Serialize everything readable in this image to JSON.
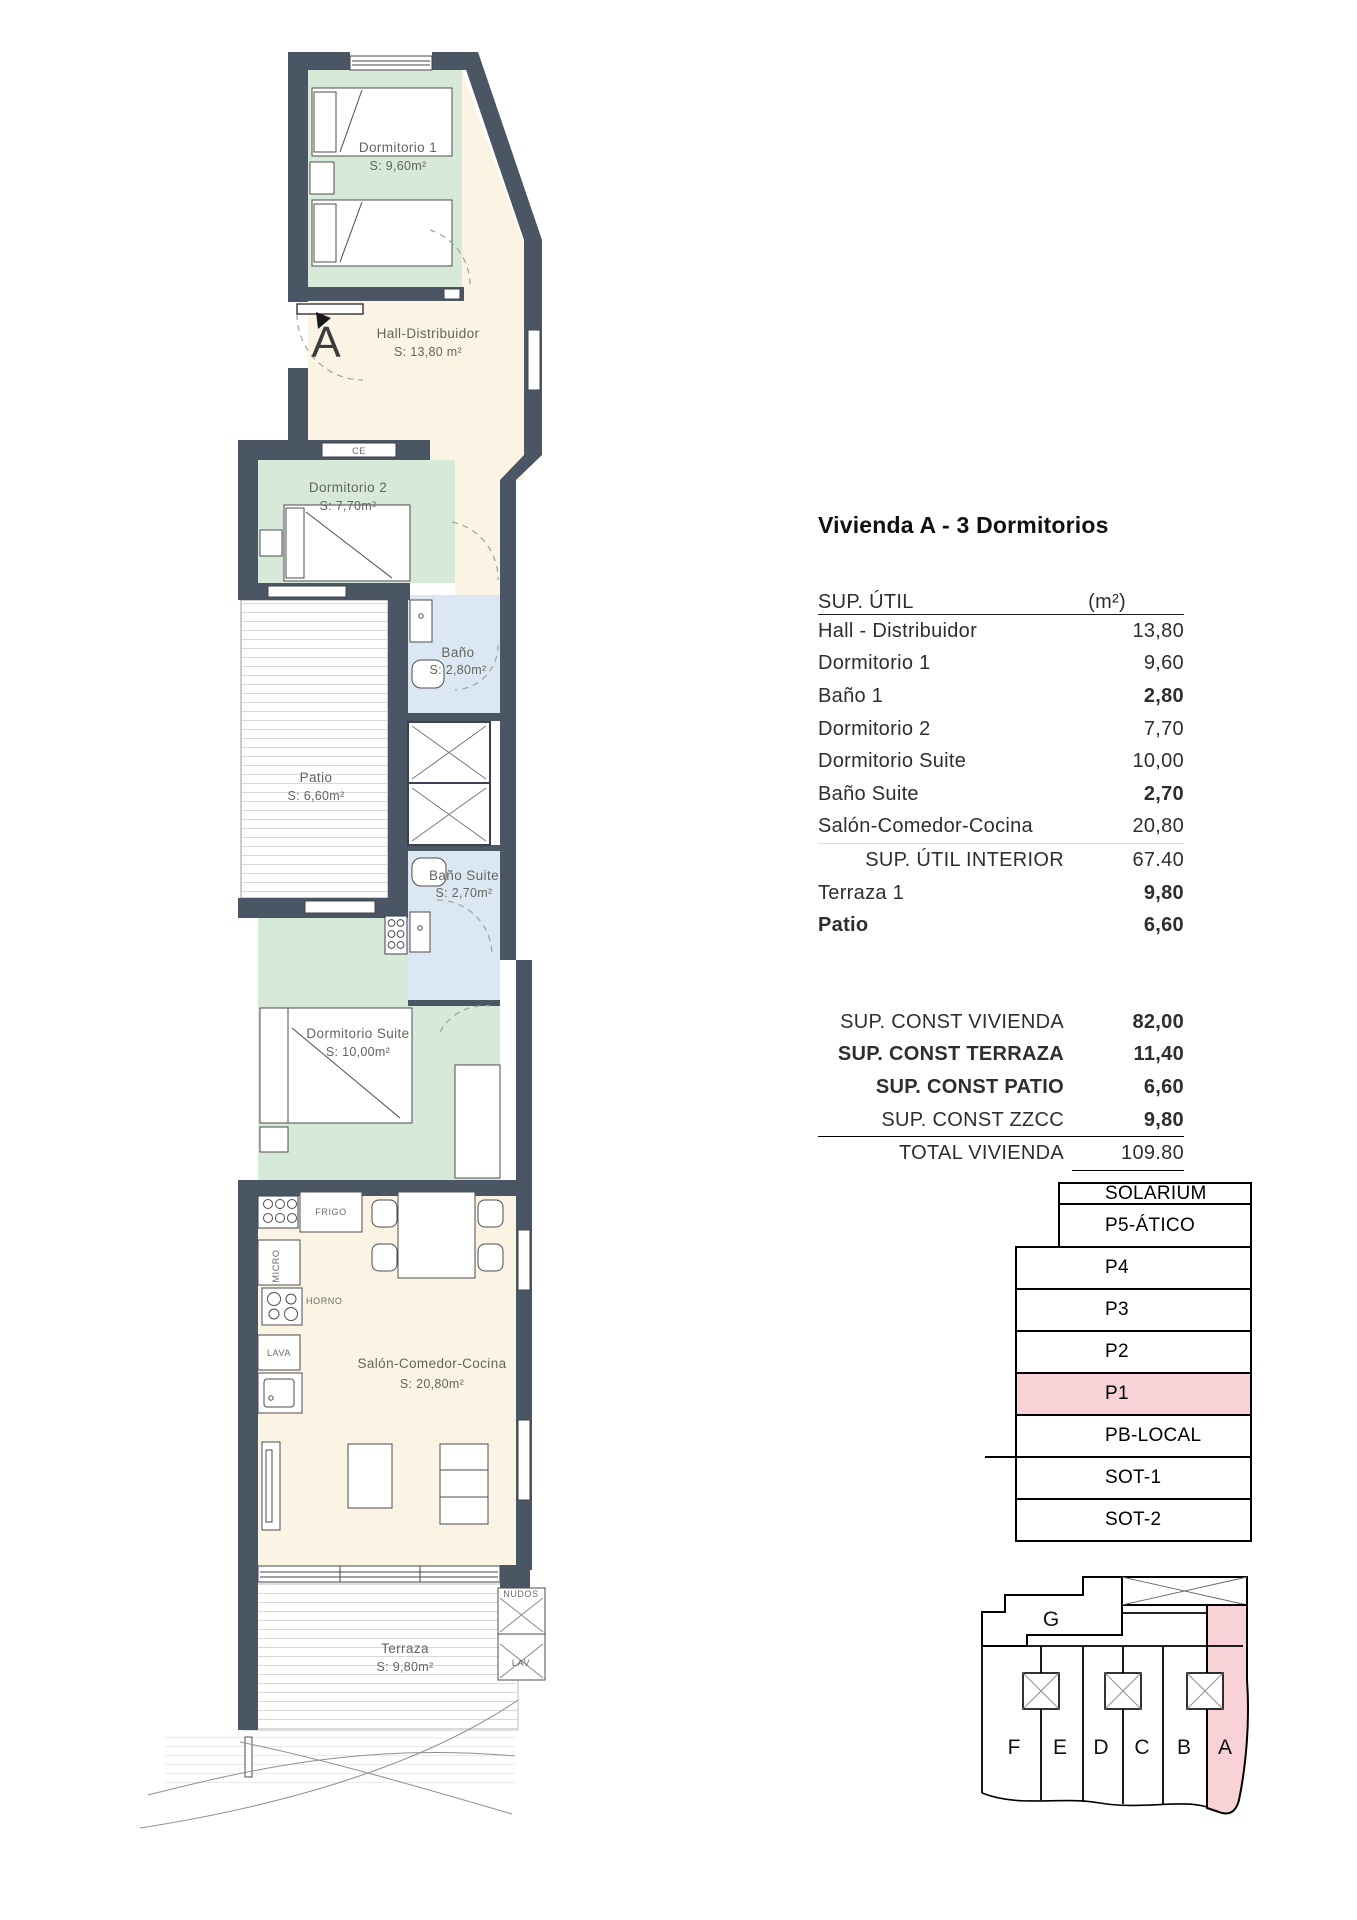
{
  "plan": {
    "marker_label": "A",
    "rooms": {
      "dormitorio1": {
        "name": "Dormitorio 1",
        "area": "S: 9,60m²"
      },
      "hall": {
        "name": "Hall-Distribuidor",
        "area": "S: 13,80 m²"
      },
      "dormitorio2": {
        "name": "Dormitorio 2",
        "area": "S: 7,70m²"
      },
      "bano": {
        "name": "Baño",
        "area": "S: 2,80m²"
      },
      "patio": {
        "name": "Patio",
        "area": "S: 6,60m²"
      },
      "bano_suite": {
        "name": "Baño Suite",
        "area": "S: 2,70m²"
      },
      "dormitorio_suite": {
        "name": "Dormitorio Suite",
        "area": "S: 10,00m²"
      },
      "salon": {
        "name": "Salón-Comedor-Cocina",
        "area": "S: 20,80m²"
      },
      "terraza": {
        "name": "Terraza",
        "area": "S: 9,80m²"
      }
    },
    "fixtures": {
      "ce": "CE",
      "frigo": "FRIGO",
      "micro": "MICRO",
      "horno": "HORNO",
      "lava": "LAVA",
      "nudos": "NUDOS",
      "lav": "LAV"
    }
  },
  "panel": {
    "title": "Vivienda A - 3 Dormitorios",
    "sup_util": {
      "header": "SUP. ÚTIL",
      "unit": "(m²)",
      "rows": [
        {
          "label": "Hall - Distribuidor",
          "value": "13,80"
        },
        {
          "label": "Dormitorio 1",
          "value": "9,60"
        },
        {
          "label": "Baño 1",
          "value": "2,80"
        },
        {
          "label": "Dormitorio 2",
          "value": "7,70"
        },
        {
          "label": "Dormitorio Suite",
          "value": "10,00"
        },
        {
          "label": "Baño Suite",
          "value": "2,70"
        },
        {
          "label": "Salón-Comedor-Cocina",
          "value": "20,80"
        },
        {
          "label": "SUP. ÚTIL INTERIOR",
          "value": "67.40"
        },
        {
          "label": "Terraza 1",
          "value": "9,80"
        },
        {
          "label": "Patio",
          "value": "6,60"
        }
      ]
    },
    "sup_const": {
      "rows": [
        {
          "label": "SUP. CONST VIVIENDA",
          "value": "82,00"
        },
        {
          "label": "SUP. CONST TERRAZA",
          "value": "11,40"
        },
        {
          "label": "SUP. CONST PATIO",
          "value": "6,60"
        },
        {
          "label": "SUP. CONST ZZCC",
          "value": "9,80"
        },
        {
          "label": "TOTAL VIVIENDA",
          "value": "109.80"
        }
      ]
    }
  },
  "levels": [
    "SOLARIUM",
    "P5-ÁTICO",
    "P4",
    "P3",
    "P2",
    "P1",
    "PB-LOCAL",
    "SOT-1",
    "SOT-2"
  ],
  "levels_highlighted": "P1",
  "keyplan": {
    "block_label": "G",
    "units": [
      "F",
      "E",
      "D",
      "C",
      "B",
      "A"
    ],
    "highlighted_unit": "A"
  },
  "colors": {
    "wall": "#4a5663",
    "bedroom_floor": "#d7e9d9",
    "hall_floor": "#fbf4e4",
    "bath_floor": "#dbe8f4",
    "highlight_pink": "#f8d2d6"
  }
}
